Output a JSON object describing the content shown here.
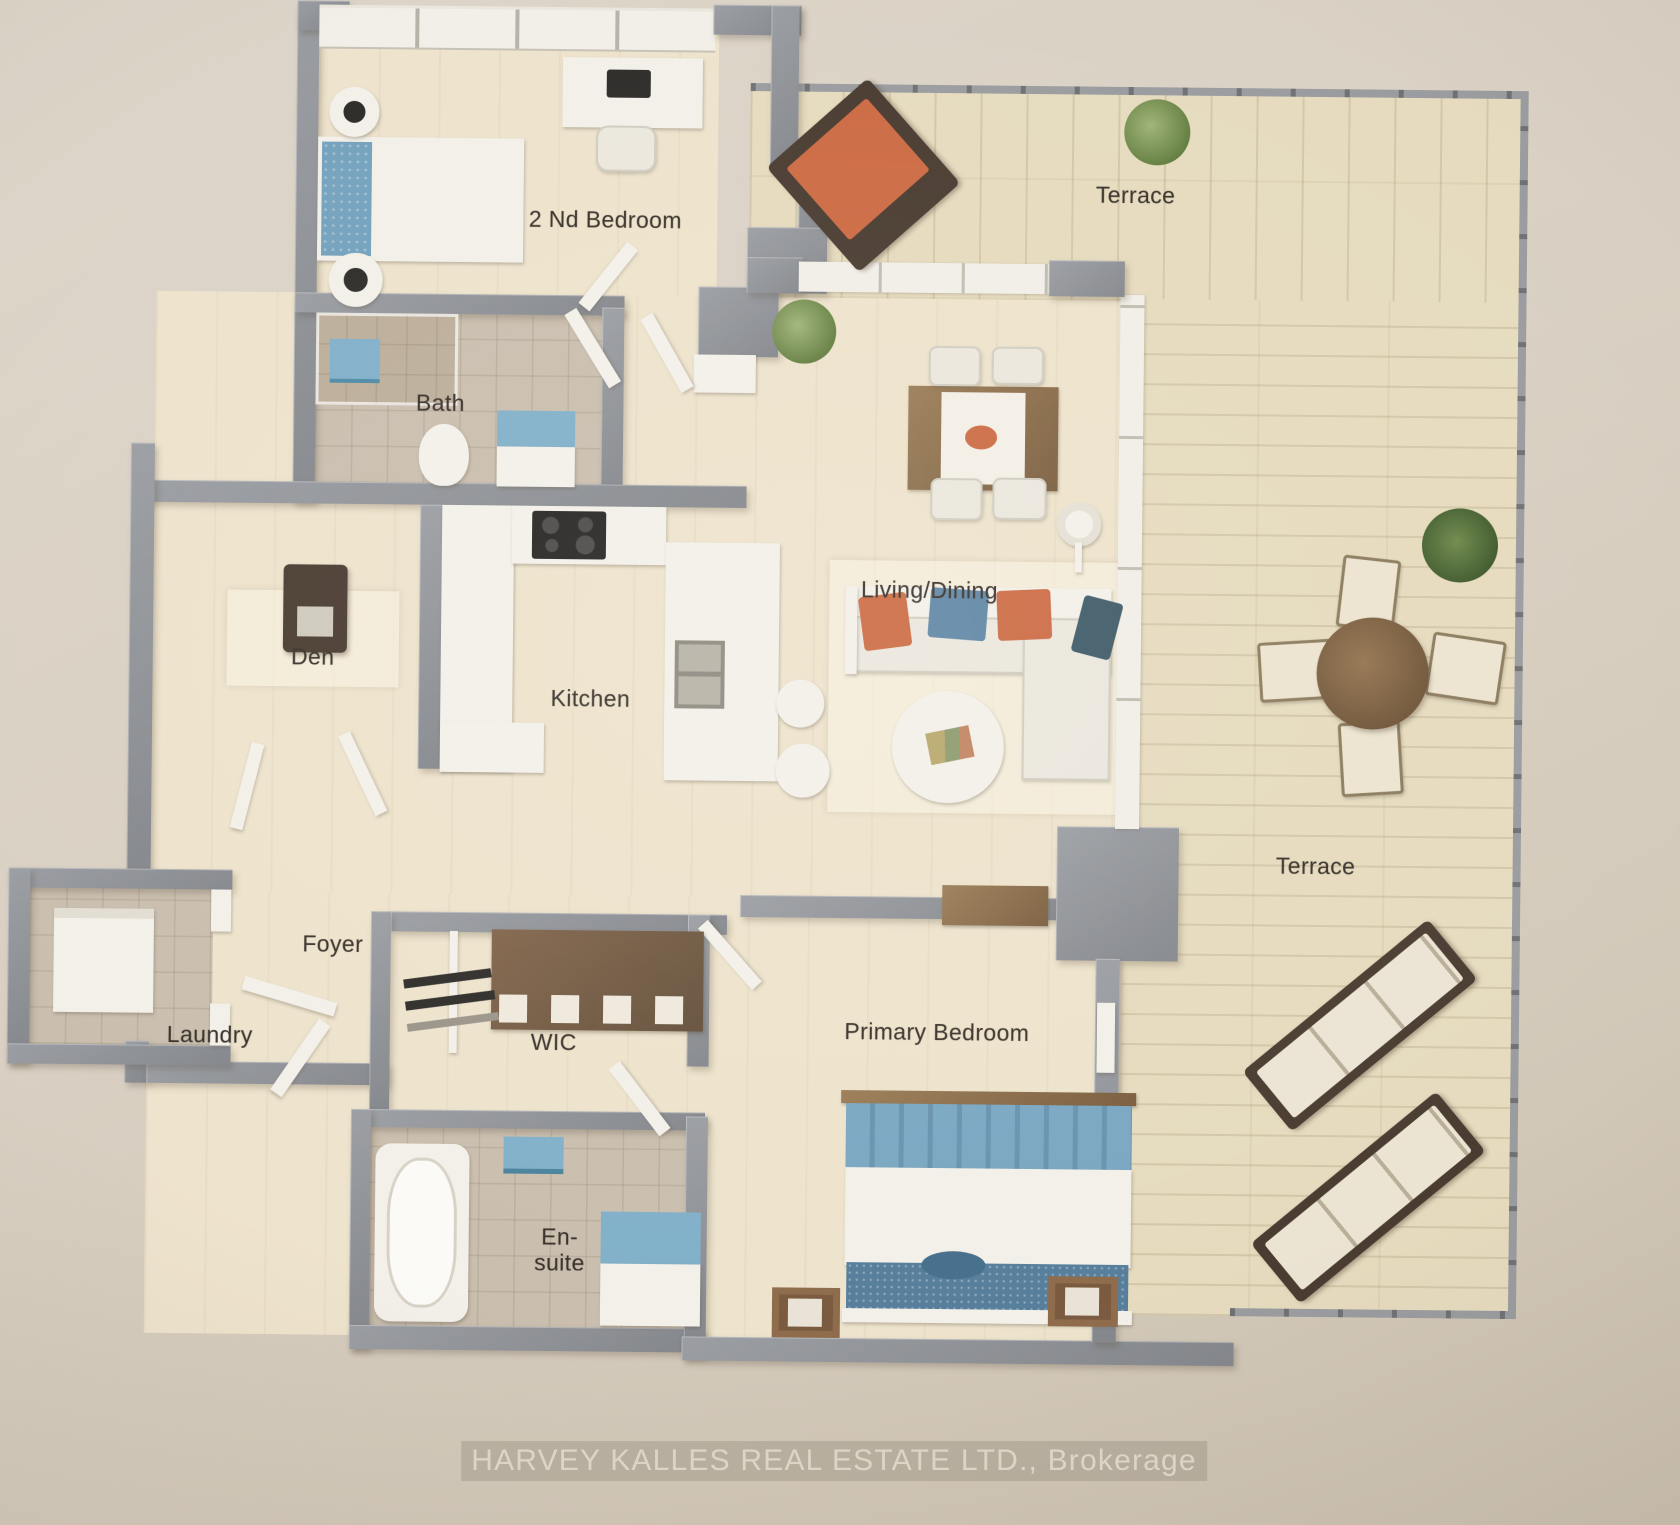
{
  "watermark": {
    "text": "HARVEY KALLES REAL ESTATE LTD., Brokerage"
  },
  "rooms": {
    "second_bedroom": {
      "label": "2 Nd Bedroom"
    },
    "terrace_top": {
      "label": "Terrace"
    },
    "bath": {
      "label": "Bath"
    },
    "den": {
      "label": "Den"
    },
    "kitchen": {
      "label": "Kitchen"
    },
    "living_dining": {
      "label": "Living/Dining"
    },
    "foyer": {
      "label": "Foyer"
    },
    "laundry": {
      "label": "Laundry"
    },
    "wic": {
      "label": "WIC"
    },
    "ensuite": {
      "label_line1": "En-",
      "label_line2": "suite"
    },
    "primary_bedroom": {
      "label": "Primary Bedroom"
    },
    "terrace_right": {
      "label": "Terrace"
    }
  },
  "colors": {
    "paper": "#d9d0c3",
    "wall": "#8e9197",
    "floor_wood": "#eee3cb",
    "floor_tile": "#cabead",
    "deck": "#e6dbbd",
    "accent_blue": "#7fb0ca",
    "accent_orange": "#cf6a42",
    "wood_brown": "#8a6c49",
    "plant_green": "#7b9457",
    "label_text": "#3a332b"
  }
}
